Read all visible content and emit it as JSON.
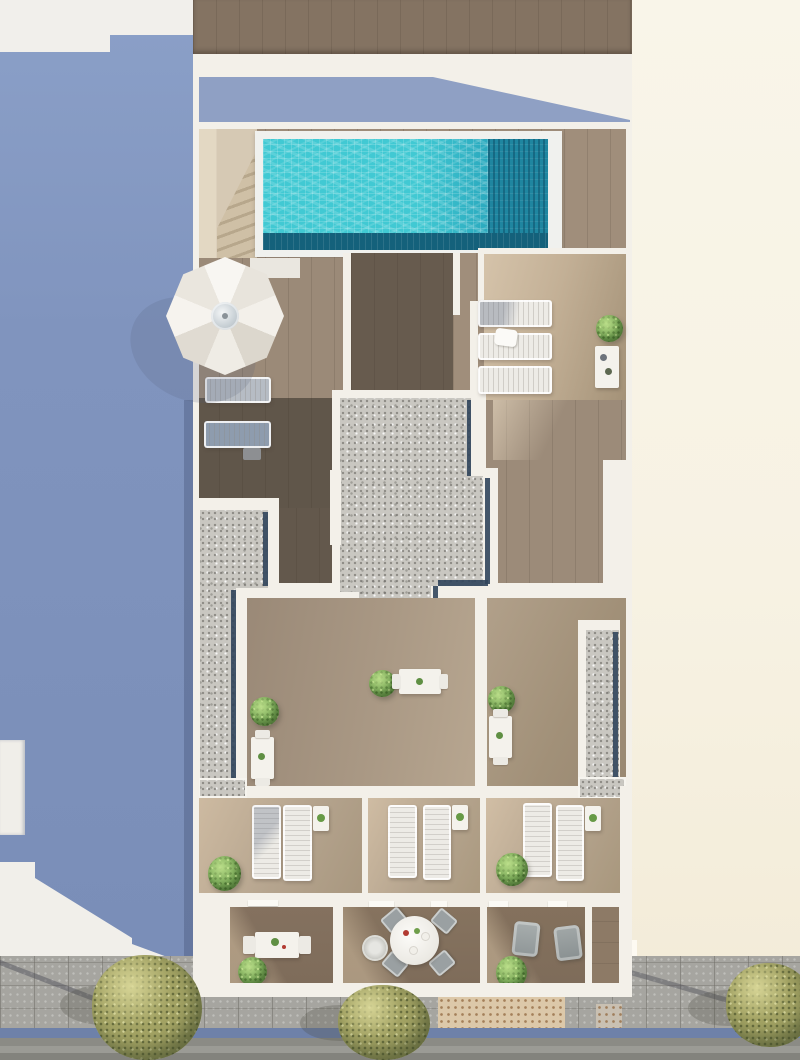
{
  "image_type": "photorealistic top-down aerial 3D architectural render, no visible text",
  "scene": {
    "view": "bird's-eye view of a residential building rooftop and terraces",
    "areas": [
      "neighbouring roof in blue shadow (left)",
      "cream party wall (right)",
      "rooftop pool deck with turquoise pool and access stair",
      "white parasol with two sun loungers",
      "three gravel roof strips with dark skylight edges",
      "three private terraces each with two sun loungers, side table and shrub",
      "three balconies with dining furniture",
      "street with sidewalk, tactile paving, blue curb, road and trees"
    ],
    "object_counts": {
      "pools": 1,
      "parasols": 1,
      "horizontal_loungers_by_parasol": 2,
      "loungers_beside_pool_terrace": 3,
      "terrace_loungers": 6,
      "small_tables": 7,
      "shrubs": 8,
      "street_trees": 3,
      "round_dining_tables": 1,
      "armchairs": 2
    }
  },
  "palette": {
    "bg-left-white": "#f1efeb",
    "wall-shadow-blue": "#8094be",
    "shadow-band-blue": "#8fa0c4",
    "building-white": "#f3f0e9",
    "cream-wall": "#f9f5e9",
    "cream-wall-deep": "#f3ecd9",
    "wood-top": "#847362",
    "deck-wood": "#a08e7b",
    "deck-wood-light": "#cdbaa1",
    "deck-wood-dark": "#60564a",
    "terrace-wood": "#b5a48e",
    "balcony-wood": "#7e6c5a",
    "pool-bright": "#41c9d3",
    "pool-mid": "#2aa8bd",
    "pool-shadow": "#1f86a0",
    "pool-dark-band": "#14617b",
    "gravel": "#c9c7c1",
    "skylight-blue": "#31455c",
    "street-pavement": "#a6a5a0",
    "street-road": "#8b8b85",
    "street-road-light": "#9b9b95",
    "street-road-dark": "#83837d",
    "curb-blue": "#6e81a9",
    "tactile-beige": "#dcc8a9",
    "tree-olive": "#a3a364",
    "bush-green": "#79a857",
    "lounger-white": "#edebe6",
    "lounger-gray": "#8e9cae",
    "furniture-gray": "#9aa0a2",
    "stairs-beige": "#d6c9b4"
  }
}
